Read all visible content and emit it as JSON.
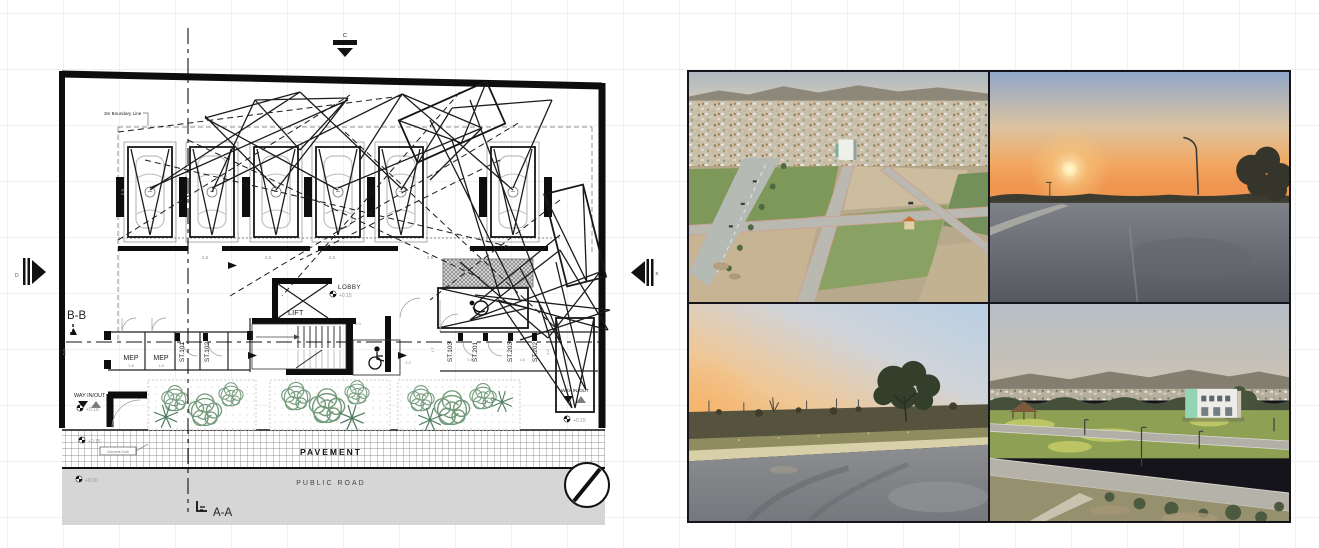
{
  "plan": {
    "boundary_note": "3m Boundary Line",
    "curb_note": "Concrete Curb",
    "markers": {
      "top": "C",
      "left": "D",
      "right": "E",
      "section_aa": "A-A",
      "section_bb": "B-B"
    },
    "rooms": {
      "mep_1": "MEP",
      "mep_2": "MEP",
      "st_101": "ST.101",
      "st_102": "ST.102",
      "st_103": "ST.103",
      "st_201": "ST.201",
      "st_203": "ST.203",
      "st_202": "ST.202",
      "lift": "LIFT",
      "lobby": "LOBBY"
    },
    "levels": {
      "lobby": "+0.15",
      "entry": "+0.15",
      "exit": "+0.15",
      "pavement": "+0.15",
      "road": "+0.00"
    },
    "circulation": {
      "way_in_out_left": "WAY IN/OUT",
      "way_in_out_right": "WAY IN/OUT"
    },
    "site": {
      "pavement": "PAVEMENT",
      "public_road": "PUBLIC ROAD"
    },
    "dimensions": {
      "stall_w1": "2.5",
      "stall_w2": "2.5",
      "stall_w3": "2.5",
      "stall_w4": "2.5",
      "stall_d": "5.0",
      "mep_w1": "1.8",
      "mep_w2": "1.8",
      "door_1": "1.8",
      "door_2": "1.8",
      "aisle": "2.2",
      "cor_1": "2.0",
      "cor_2": "2.0",
      "side": "2.5",
      "misc_1": "1.7"
    }
  },
  "photos": {
    "top_left": {
      "description": "aerial view of city, highway and empty development plots"
    },
    "top_right": {
      "description": "sunset over an empty asphalt road"
    },
    "bottom_left": {
      "description": "dusk road with tree and scrub verge"
    },
    "bottom_right": {
      "description": "elevated dusk view of white building with green accent beside road"
    }
  },
  "palette": {
    "plan_line": "#1c1c1c",
    "planting_green": "#5c8a63",
    "road_gray": "#d6d6d6",
    "photo_gap": "#14141a",
    "sunset_orange": "#ef9550",
    "building_mint": "#95d3b5"
  }
}
